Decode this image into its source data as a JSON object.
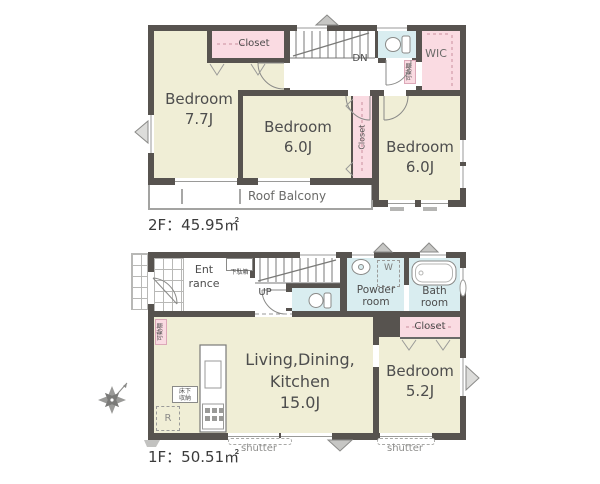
{
  "colors": {
    "room_beige": "#f0eed6",
    "closet_pink": "#fadbe2",
    "wet_cyan": "#d9edf0",
    "wall": "#57534f"
  },
  "floor2": {
    "area_label": "2F：45.95㎡",
    "bedroom1_name": "Bedroom",
    "bedroom1_size": "7.7J",
    "bedroom2_name": "Bedroom",
    "bedroom2_size": "6.0J",
    "bedroom3_name": "Bedroom",
    "bedroom3_size": "6.0J",
    "closet_top": "Closet",
    "closet_mid": "Closet",
    "wic": "WIC",
    "balcony": "Roof Balcony",
    "stairs_dn": "DN",
    "movable_shelf": "可動棚"
  },
  "floor1": {
    "area_label": "1F：50.51㎡",
    "entrance_line1": "Ent",
    "entrance_line2": "rance",
    "ldk_line1": "Living,Dining,",
    "ldk_line2": "Kitchen",
    "ldk_line3": "15.0J",
    "bedroom_name": "Bedroom",
    "bedroom_size": "5.2J",
    "powder_line1": "Powder",
    "powder_line2": "room",
    "bath_line1": "Bath",
    "bath_line2": "room",
    "closet": "Closet",
    "stairs_up": "UP",
    "shoe_cabinet": "下駄箱",
    "floor_storage_line1": "床下",
    "floor_storage_line2": "収納",
    "movable_shelf": "可動棚",
    "washer": "W",
    "fridge": "R",
    "shutter_left": "shutter",
    "shutter_right": "shutter"
  }
}
